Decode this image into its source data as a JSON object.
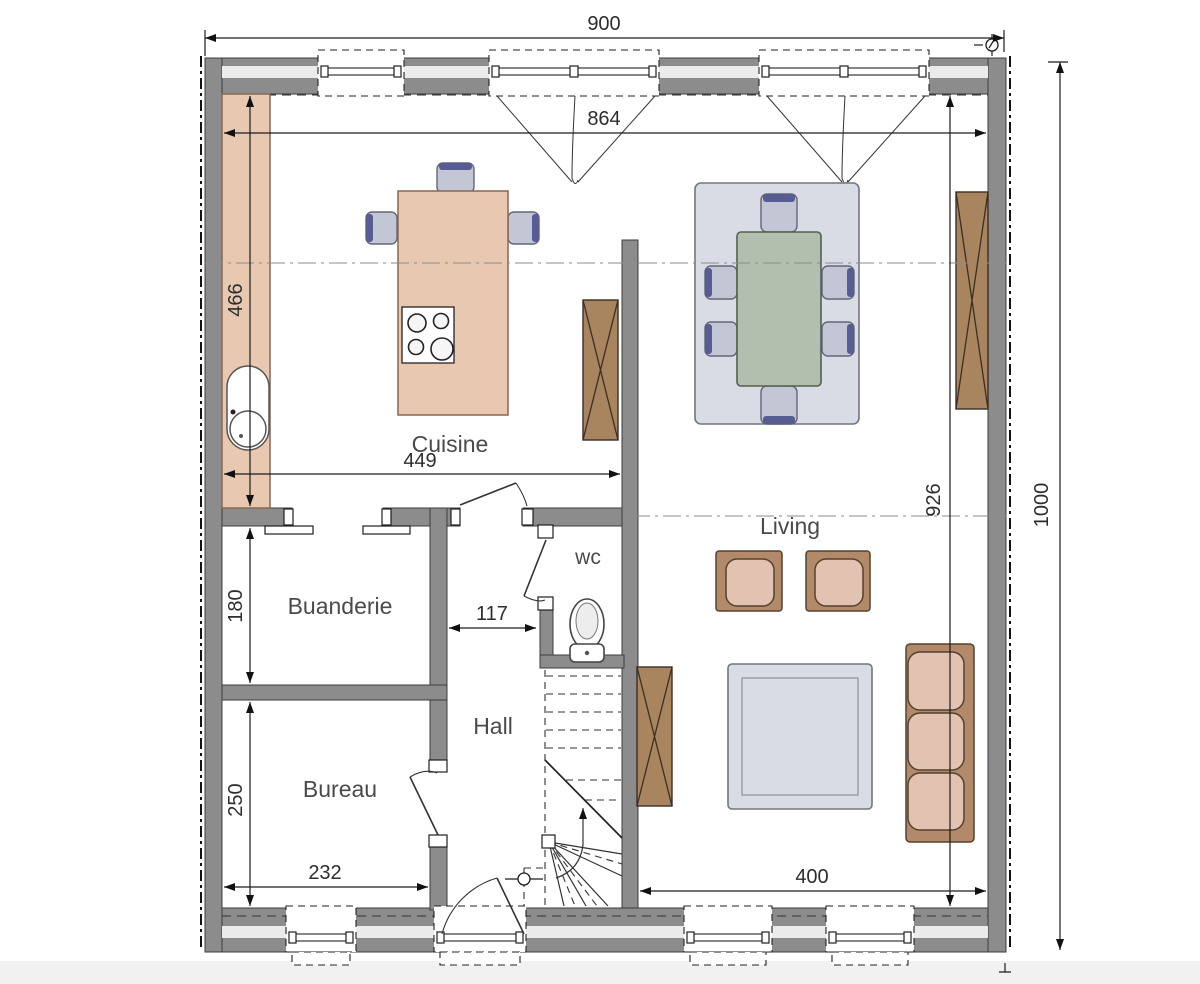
{
  "rooms": {
    "cuisine": "Cuisine",
    "buanderie": "Buanderie",
    "bureau": "Bureau",
    "hall": "Hall",
    "wc": "wc",
    "living": "Living"
  },
  "dimensions": {
    "overall_width": "900",
    "interior_width": "864",
    "kitchen_depth": "466",
    "kitchen_width": "449",
    "interior_depth": "926",
    "overall_depth": "1000",
    "buanderie_depth": "180",
    "bureau_depth": "250",
    "bureau_width": "232",
    "hall_passage": "117",
    "living_width": "400"
  },
  "colors": {
    "wall": "#8c8c8c",
    "cavity": "#ebebeb",
    "wood": "#e8c8b1",
    "wood_edge": "#8a6750",
    "frame": "#b28a6a",
    "cushion": "#e2c2b0",
    "cabinet": "#a8845f",
    "table": "#b2bfae",
    "rug": "#d9dbe5",
    "chair": "#c3c6d4",
    "chair_accent": "#575c92",
    "ink": "#2d2d2d",
    "label": "#4a4a4a"
  }
}
